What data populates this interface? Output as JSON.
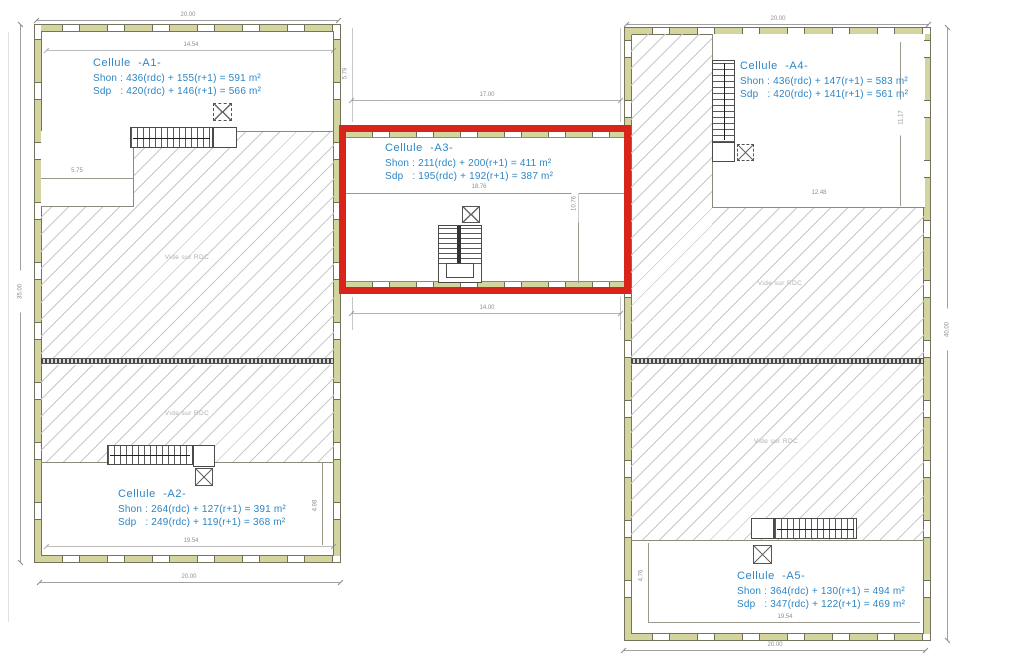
{
  "cells": {
    "a1": {
      "title": "Cellule  -A1-",
      "shon": "Shon : 436(rdc) + 155(r+1) = 591 m²",
      "sdp": "Sdp   : 420(rdc) + 146(r+1) = 566 m²"
    },
    "a2": {
      "title": "Cellule  -A2-",
      "shon": "Shon : 264(rdc) + 127(r+1) = 391 m²",
      "sdp": "Sdp   : 249(rdc) + 119(r+1) = 368 m²"
    },
    "a3": {
      "title": "Cellule  -A3-",
      "shon": "Shon : 211(rdc) + 200(r+1) = 411 m²",
      "sdp": "Sdp   : 195(rdc) + 192(r+1) = 387 m²"
    },
    "a4": {
      "title": "Cellule  -A4-",
      "shon": "Shon : 436(rdc) + 147(r+1) = 583 m²",
      "sdp": "Sdp   : 420(rdc) + 141(r+1) = 561 m²"
    },
    "a5": {
      "title": "Cellule  -A5-",
      "shon": "Shon : 364(rdc) + 130(r+1) = 494 m²",
      "sdp": "Sdp   : 347(rdc) + 122(r+1) = 469 m²"
    }
  },
  "labels": {
    "vide_rdc": "Vide sur RDC"
  },
  "dimensions": {
    "left_building_top_width": "20.00",
    "right_building_top_width": "20.00",
    "left_building_bottom_width": "20.00",
    "right_building_bottom_width": "20.00",
    "left_building_height": "35.00",
    "right_building_height": "40.00",
    "a1_interior_width": "14.54",
    "a2_interior_width": "19.54",
    "a5_interior_width": "19.54",
    "a3_interior_width": "18.76",
    "a3_interior_height": "10.76",
    "a4_interior_width": "12.48",
    "mid_top_width": "17.00",
    "mid_bottom_width": "14.00",
    "a1_step_width": "5.75",
    "a2_interior_height": "4.98",
    "a4_interior_height": "11.17",
    "a5_interior_height": "4.76",
    "mid_left_height": "5.79"
  },
  "colors": {
    "highlight_red": "#d8241b",
    "label_blue": "#2e86c5",
    "wall_fill": "#d4d49e",
    "dimension_gray": "#8f8f8f"
  }
}
